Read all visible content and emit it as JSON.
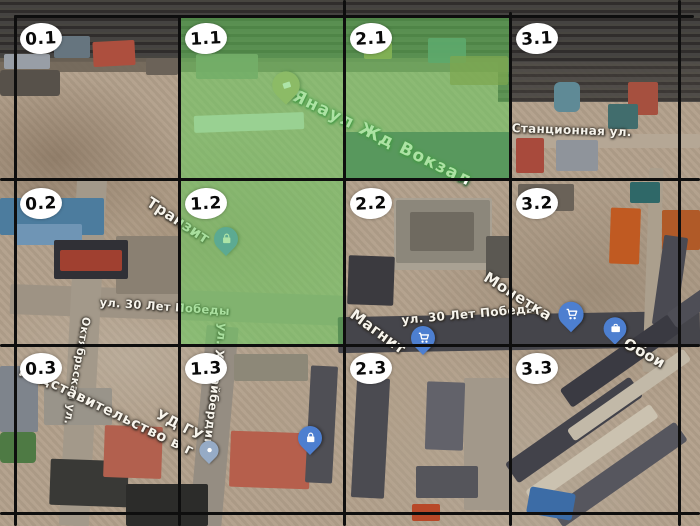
{
  "app": {
    "type": "satellite-map-with-annotation-grid",
    "description": "Aerial photo of Yanaul with hand-drawn 4x3 numbered grid; three cells highlighted green"
  },
  "colors": {
    "grid_line": "#0e0e0e",
    "highlight_green": "rgba(105,205,95,0.55)",
    "cell_label_bg": "#ffffff",
    "cell_label_text": "#0a0a0a",
    "pin_blue": "#4d7fd0",
    "pin_station_tan": "#b7a470",
    "pin_gray": "#96abc6",
    "street_text": "#f7f4ec"
  },
  "grid": {
    "columns": 4,
    "rows": 3,
    "cells": [
      {
        "id": "0.1",
        "highlighted": false
      },
      {
        "id": "1.1",
        "highlighted": true
      },
      {
        "id": "2.1",
        "highlighted": true
      },
      {
        "id": "3.1",
        "highlighted": false
      },
      {
        "id": "0.2",
        "highlighted": false
      },
      {
        "id": "1.2",
        "highlighted": true
      },
      {
        "id": "2.2",
        "highlighted": false
      },
      {
        "id": "3.2",
        "highlighted": false
      },
      {
        "id": "0.3",
        "highlighted": false
      },
      {
        "id": "1.3",
        "highlighted": false
      },
      {
        "id": "2.3",
        "highlighted": false
      },
      {
        "id": "3.3",
        "highlighted": false
      }
    ]
  },
  "map_labels": [
    {
      "id": "yanaul-station",
      "text": "Янаул Жд Вокзал",
      "x": 297,
      "y": 88,
      "rotation": 26,
      "size": 17,
      "style": "poi-green"
    },
    {
      "id": "stantsionnaya-street",
      "text": "Станционная ул.",
      "x": 512,
      "y": 122,
      "rotation": 2,
      "size": 12,
      "style": "street"
    },
    {
      "id": "tranzit",
      "text": "Транзит",
      "x": 152,
      "y": 195,
      "rotation": 33,
      "size": 15,
      "style": "street"
    },
    {
      "id": "pobedy-street-left",
      "text": "ул. 30 Лет Победы",
      "x": 100,
      "y": 297,
      "rotation": 4,
      "size": 11.5,
      "style": "street"
    },
    {
      "id": "pobedy-street-right",
      "text": "ул. 30 Лет Победы",
      "x": 401,
      "y": 314,
      "rotation": -5,
      "size": 12,
      "style": "street"
    },
    {
      "id": "magnit",
      "text": "Магнит",
      "x": 356,
      "y": 307,
      "rotation": 36,
      "size": 15,
      "style": "street"
    },
    {
      "id": "monetka",
      "text": "Монетка",
      "x": 489,
      "y": 270,
      "rotation": 32,
      "size": 15,
      "style": "street"
    },
    {
      "id": "oboi",
      "text": "Обои",
      "x": 628,
      "y": 336,
      "rotation": 29,
      "size": 15,
      "style": "street"
    },
    {
      "id": "oktyabrskaya-street",
      "text": "Октябрьская ул.",
      "x": 92,
      "y": 318,
      "rotation": 100,
      "size": 11,
      "style": "street"
    },
    {
      "id": "khudayberdina-street",
      "text": "ул. Худайбердина",
      "x": 229,
      "y": 324,
      "rotation": 97,
      "size": 12,
      "style": "street"
    },
    {
      "id": "predstavitelstvo",
      "text": "редставительство в г",
      "x": 24,
      "y": 362,
      "rotation": 26,
      "size": 14.5,
      "style": "street-big"
    },
    {
      "id": "udgu",
      "text": "УД ГУ",
      "x": 160,
      "y": 408,
      "rotation": 27,
      "size": 14,
      "style": "street-big"
    }
  ],
  "pins": [
    {
      "id": "railway-station-pin",
      "icon": "train-station-icon",
      "x": 286,
      "y": 105,
      "color": "#b7a470",
      "scale": 1.15
    },
    {
      "id": "tranzit-pin",
      "icon": "shopping-bag-icon",
      "x": 226,
      "y": 257,
      "color": "#4d7fd0",
      "scale": 1
    },
    {
      "id": "magnit-pin",
      "icon": "shopping-cart-icon",
      "x": 423,
      "y": 356,
      "color": "#4d7fd0",
      "scale": 1
    },
    {
      "id": "monetka-pin",
      "icon": "shopping-cart-icon",
      "x": 571,
      "y": 333,
      "color": "#4d7fd0",
      "scale": 1.05
    },
    {
      "id": "oboi-pin",
      "icon": "briefcase-icon",
      "x": 615,
      "y": 346,
      "color": "#4d7fd0",
      "scale": 0.95
    },
    {
      "id": "shop-pin-1-3",
      "icon": "shopping-bag-icon",
      "x": 310,
      "y": 456,
      "color": "#4d7fd0",
      "scale": 1
    },
    {
      "id": "gray-pin",
      "icon": "dot-icon",
      "x": 209,
      "y": 466,
      "color": "#96abc6",
      "scale": 0.8
    }
  ]
}
